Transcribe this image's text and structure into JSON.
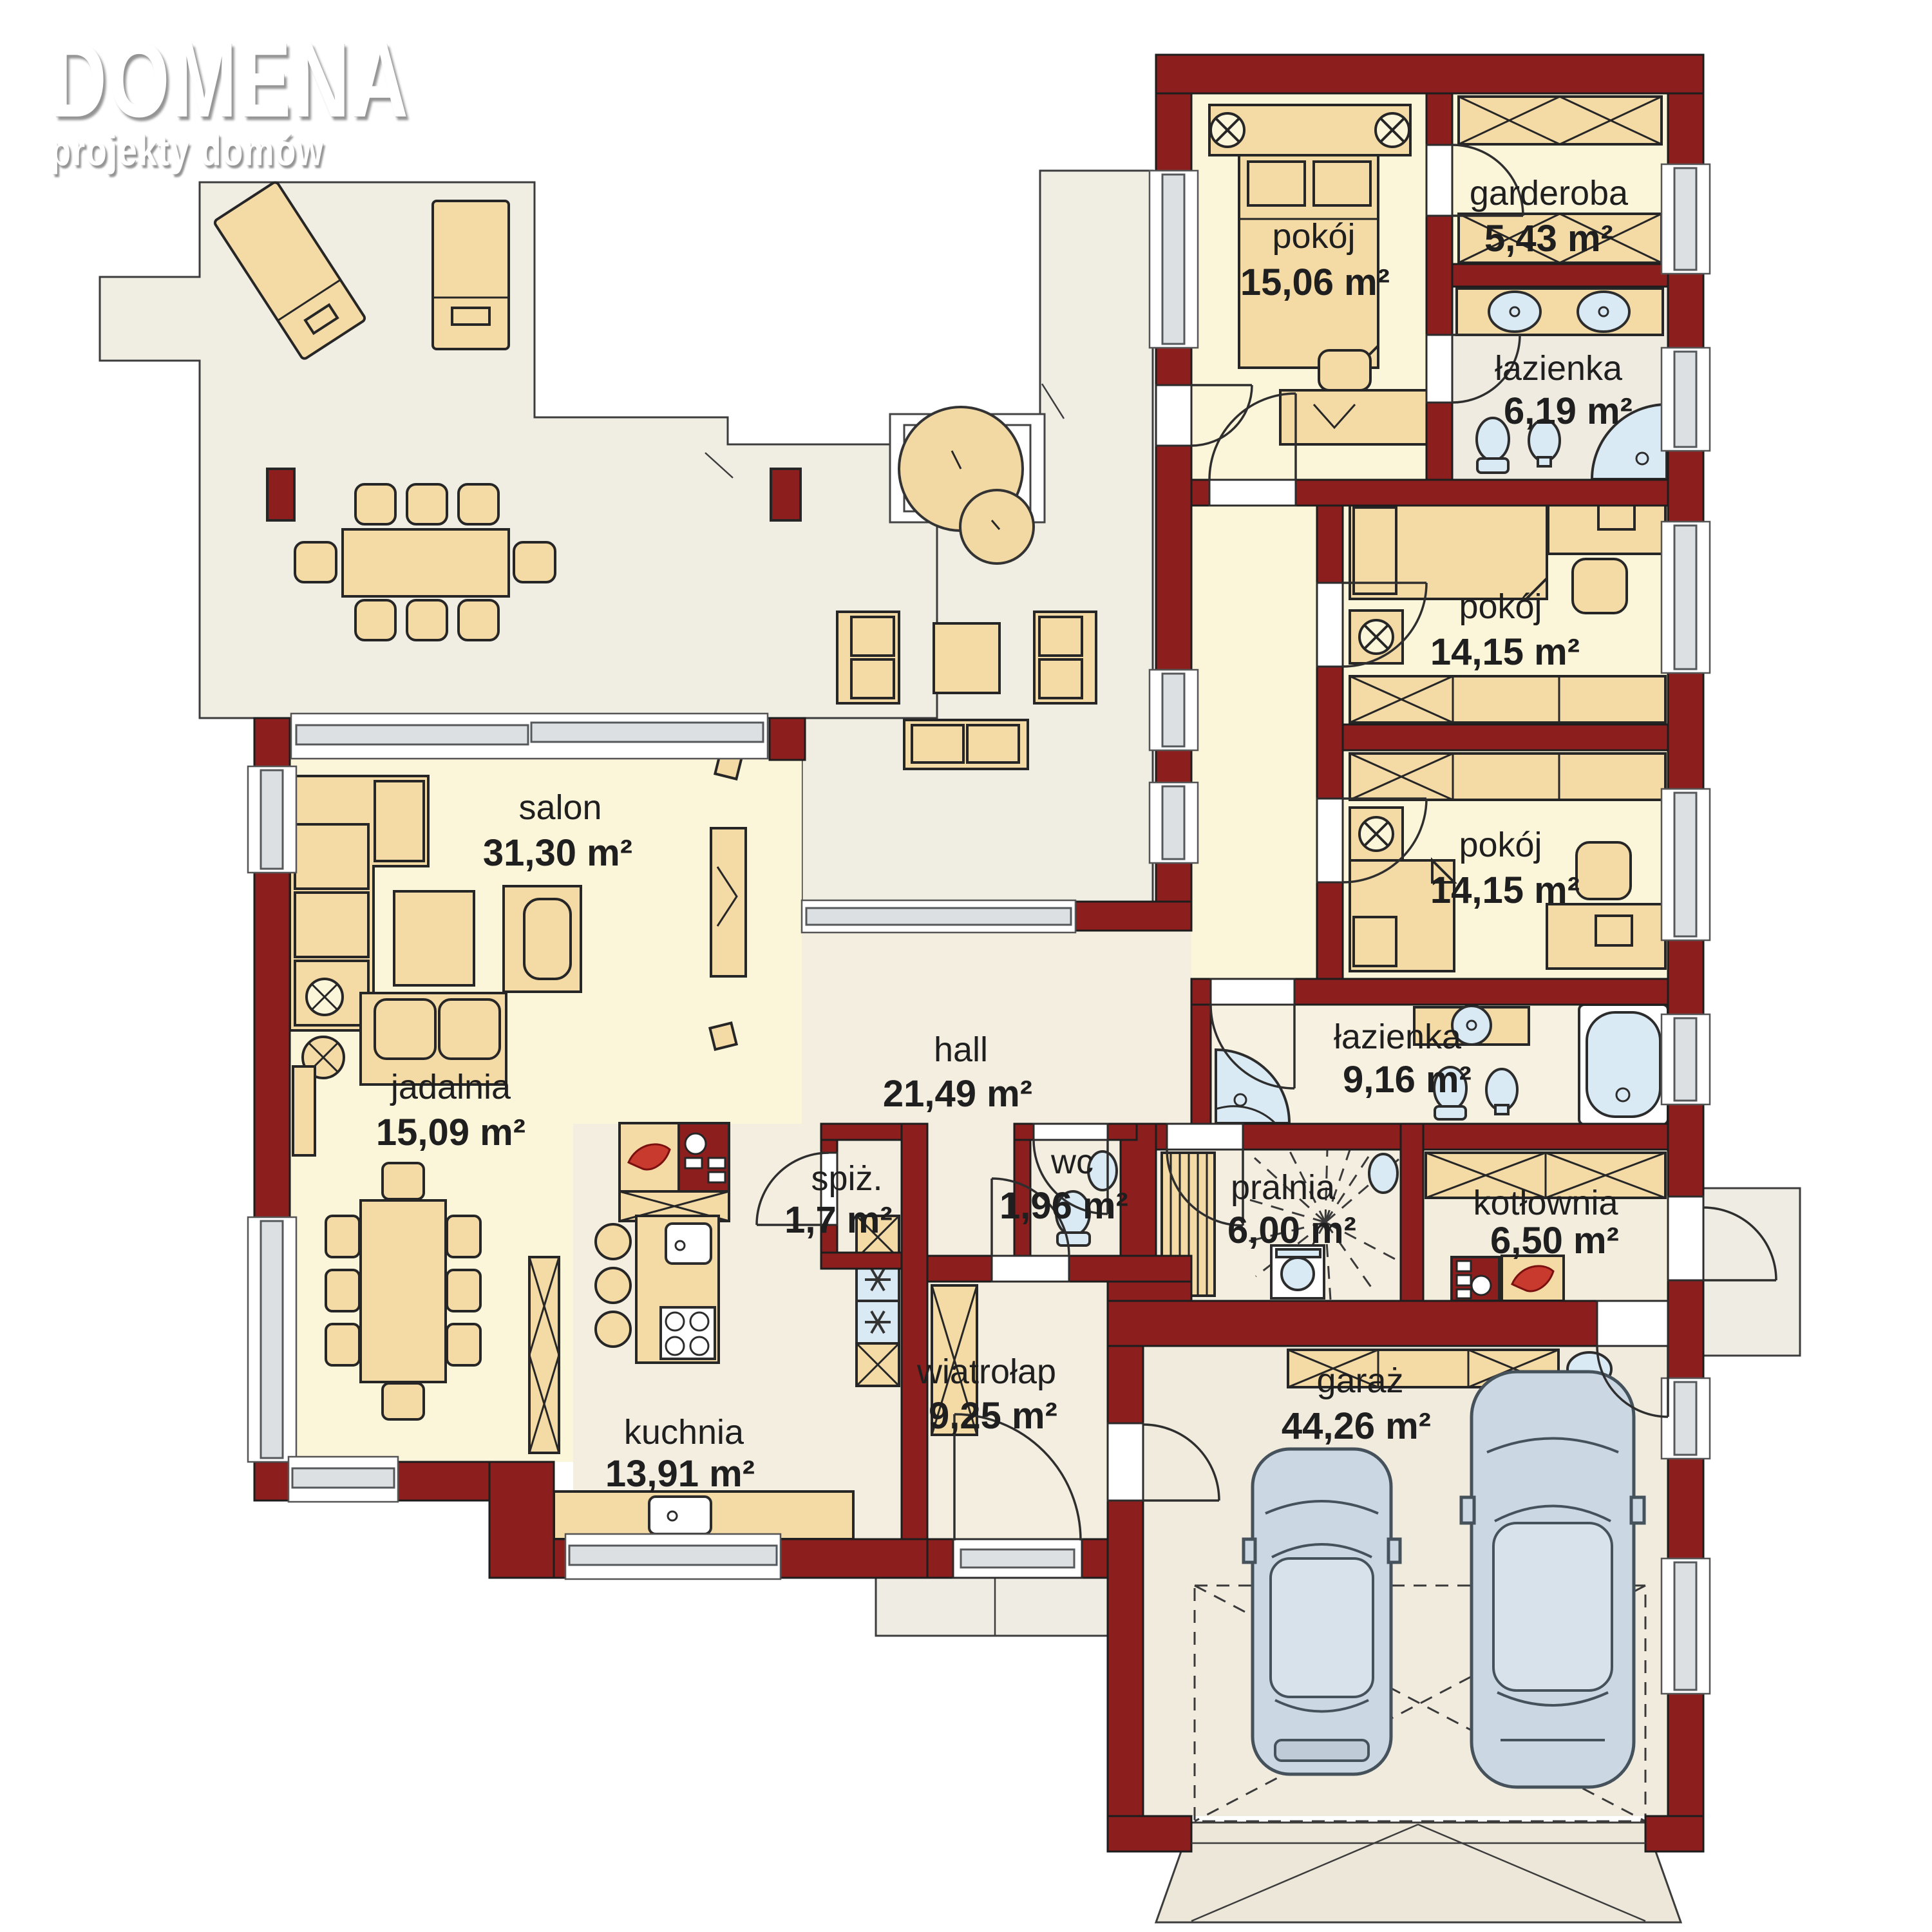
{
  "brand": {
    "name": "DOMENA",
    "tagline": "projekty domów"
  },
  "rooms": [
    {
      "name": "pokój",
      "area": "15,06 m²"
    },
    {
      "name": "garderoba",
      "area": "5,43 m²"
    },
    {
      "name": "łazienka",
      "area": "6,19 m²"
    },
    {
      "name": "pokój",
      "area": "14,15 m²"
    },
    {
      "name": "pokój",
      "area": "14,15 m²"
    },
    {
      "name": "łazienka",
      "area": "9,16 m²"
    },
    {
      "name": "salon",
      "area": "31,30 m²"
    },
    {
      "name": "jadalnia",
      "area": "15,09 m²"
    },
    {
      "name": "hall",
      "area": "21,49 m²"
    },
    {
      "name": "wc",
      "area": "1,96 m²"
    },
    {
      "name": "pralnia",
      "area": "6,00 m²"
    },
    {
      "name": "kotłownia",
      "area": "6,50 m²"
    },
    {
      "name": "spiż.",
      "area": "1,7 m²"
    },
    {
      "name": "wiatrołap",
      "area": "9,25 m²"
    },
    {
      "name": "kuchnia",
      "area": "13,91 m²"
    },
    {
      "name": "garaż",
      "area": "44,26 m²"
    }
  ],
  "colors": {
    "wall": "#8C1E1E",
    "furniture": "#F4DAA5",
    "floor_cream": "#FBF5D9",
    "floor_terrace": "#F0EDE3",
    "fixture_blue": "#D9EAF4",
    "car_body": "#CBD8E3",
    "flame_accent": "#C83A2E"
  }
}
